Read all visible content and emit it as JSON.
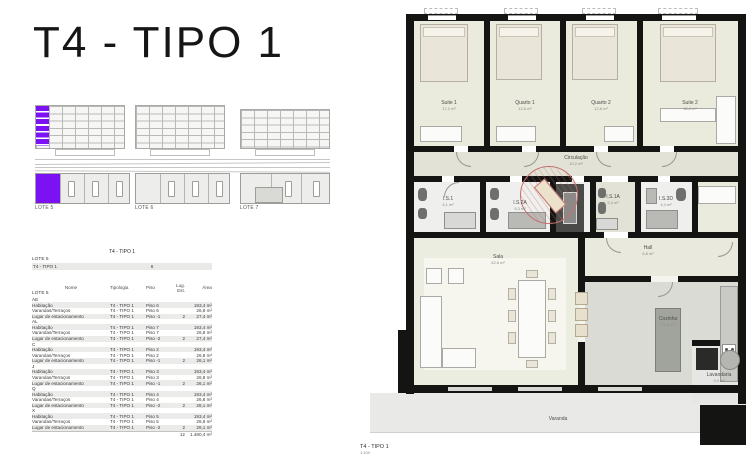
{
  "colors": {
    "accent_purple": "#7c12f4",
    "stamp_red": "#c4726f"
  },
  "header": {
    "title": "T4 - TIPO 1"
  },
  "site_diagrams": {
    "lot_labels": [
      "LOTE 5",
      "LOTE 6",
      "LOTE 7"
    ]
  },
  "summary": {
    "table_title": "T4 - TIPO 1",
    "lot": "LOTE 5",
    "type_label": "T4 - TIPO 1",
    "unit_count": "6"
  },
  "area_table": {
    "lot": "LOTE 5",
    "headers": {
      "nome": "Nome",
      "tipologia": "Tipologia",
      "piso": "Piso",
      "lug": "Lug. Est.",
      "area": "Área"
    },
    "groups": [
      {
        "unit": "AE",
        "rows": [
          {
            "nome": "Habitação",
            "tipologia": "T4 - TIPO 1",
            "piso": "Piso 6",
            "lug": "",
            "area": "193,4 m²"
          },
          {
            "nome": "Varandas/Terraços",
            "tipologia": "T4 - TIPO 1",
            "piso": "Piso 6",
            "lug": "",
            "area": "26,8 m²"
          },
          {
            "nome": "Lugar de estacionamento",
            "tipologia": "T4 - TIPO 1",
            "piso": "Piso -1",
            "lug": "2",
            "area": "27,4 m²"
          }
        ]
      },
      {
        "unit": "AL",
        "rows": [
          {
            "nome": "Habitação",
            "tipologia": "T4 - TIPO 1",
            "piso": "Piso 7",
            "lug": "",
            "area": "193,4 m²"
          },
          {
            "nome": "Varandas/Terraços",
            "tipologia": "T4 - TIPO 1",
            "piso": "Piso 7",
            "lug": "",
            "area": "26,8 m²"
          },
          {
            "nome": "Lugar de estacionamento",
            "tipologia": "T4 - TIPO 1",
            "piso": "Piso -2",
            "lug": "2",
            "area": "27,4 m²"
          }
        ]
      },
      {
        "unit": "C",
        "rows": [
          {
            "nome": "Habitação",
            "tipologia": "T4 - TIPO 1",
            "piso": "Piso 2",
            "lug": "",
            "area": "193,4 m²"
          },
          {
            "nome": "Varandas/Terraços",
            "tipologia": "T4 - TIPO 1",
            "piso": "Piso 2",
            "lug": "",
            "area": "26,8 m²"
          },
          {
            "nome": "Lugar de estacionamento",
            "tipologia": "T4 - TIPO 1",
            "piso": "Piso -1",
            "lug": "2",
            "area": "26,1 m²"
          }
        ]
      },
      {
        "unit": "J",
        "rows": [
          {
            "nome": "Habitação",
            "tipologia": "T4 - TIPO 1",
            "piso": "Piso 3",
            "lug": "",
            "area": "193,4 m²"
          },
          {
            "nome": "Varandas/Terraços",
            "tipologia": "T4 - TIPO 1",
            "piso": "Piso 3",
            "lug": "",
            "area": "26,8 m²"
          },
          {
            "nome": "Lugar de estacionamento",
            "tipologia": "T4 - TIPO 1",
            "piso": "Piso -1",
            "lug": "2",
            "area": "26,1 m²"
          }
        ]
      },
      {
        "unit": "Q",
        "rows": [
          {
            "nome": "Habitação",
            "tipologia": "T4 - TIPO 1",
            "piso": "Piso 4",
            "lug": "",
            "area": "193,4 m²"
          },
          {
            "nome": "Varandas/Terraços",
            "tipologia": "T4 - TIPO 1",
            "piso": "Piso 4",
            "lug": "",
            "area": "26,8 m²"
          },
          {
            "nome": "Lugar de estacionamento",
            "tipologia": "T4 - TIPO 1",
            "piso": "Piso -2",
            "lug": "2",
            "area": "26,1 m²"
          }
        ]
      },
      {
        "unit": "X",
        "rows": [
          {
            "nome": "Habitação",
            "tipologia": "T4 - TIPO 1",
            "piso": "Piso 5",
            "lug": "",
            "area": "193,4 m²"
          },
          {
            "nome": "Varandas/Terraços",
            "tipologia": "T4 - TIPO 1",
            "piso": "Piso 5",
            "lug": "",
            "area": "26,8 m²"
          },
          {
            "nome": "Lugar de estacionamento",
            "tipologia": "T4 - TIPO 1",
            "piso": "Piso -2",
            "lug": "2",
            "area": "26,1 m²"
          }
        ]
      }
    ],
    "total": {
      "lug": "12",
      "area": "1.480,4 m²"
    }
  },
  "floor_plan": {
    "caption": "T4 - TIPO 1",
    "scale": "1:100",
    "rooms": {
      "suite1": {
        "name": "Suite 1",
        "area": "17,2 m²"
      },
      "quarto1": {
        "name": "Quarto 1",
        "area": "12,6 m²"
      },
      "quarto2": {
        "name": "Quarto 2",
        "area": "12,6 m²"
      },
      "suite2": {
        "name": "Suite 2",
        "area": "18,4 m²"
      },
      "circulacao": {
        "name": "Circulação",
        "area": "10,2 m²"
      },
      "is1": {
        "name": "I.S.1",
        "area": "4,1 m²"
      },
      "is2a": {
        "name": "I.S.2A",
        "area": "5,3 m²"
      },
      "is1a": {
        "name": "I.S.1A",
        "area": "2,4 m²"
      },
      "is3d": {
        "name": "I.S.3D",
        "area": "4,4 m²"
      },
      "hall": {
        "name": "Hall",
        "area": "6,8 m²"
      },
      "sala": {
        "name": "Sala",
        "area": "52,6 m²"
      },
      "cozinha": {
        "name": "Cozinha",
        "area": "17,8 m²"
      },
      "lavandaria": {
        "name": "Lavandaria",
        "area": "3,9 m²"
      },
      "varanda": {
        "name": "Varanda",
        "area": "26,8 m²"
      }
    }
  }
}
